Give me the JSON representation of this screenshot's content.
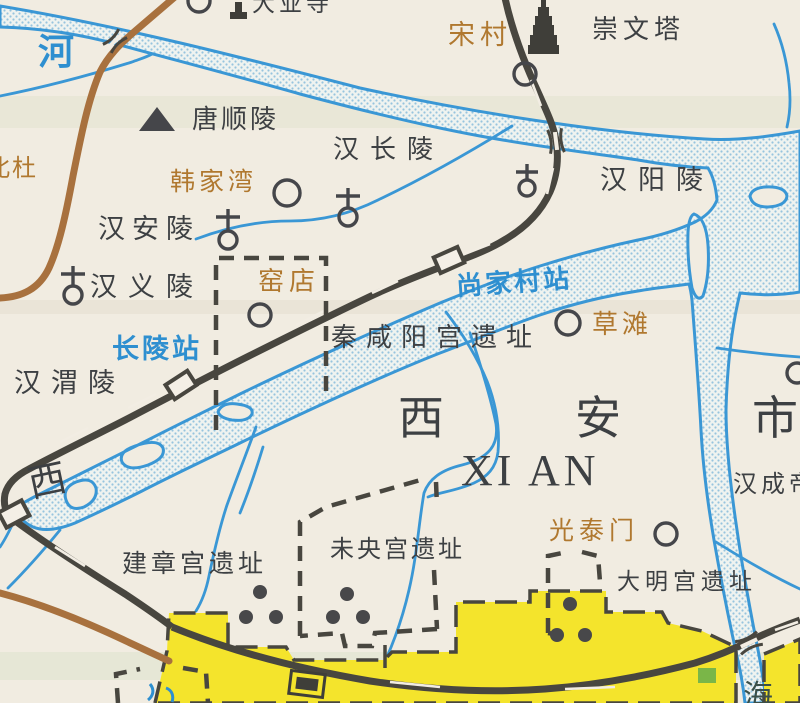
{
  "map": {
    "region_name_zh": "西安市",
    "region_name_en": "XI AN",
    "labels": {
      "dayesi_temple": "大业寺",
      "songcun_village": "宋村",
      "chongwenta_pagoda": "崇文塔",
      "river_char": "河",
      "tangshunling_tomb": "唐顺陵",
      "hanchangling_tomb": "汉长陵",
      "hanyangling_tomb": "汉阳陵",
      "hanjiawan_village": "韩家湾",
      "hananling_tomb": "汉安陵",
      "beidu_village": "北杜",
      "hanyiling_tomb": "汉义陵",
      "yaodian_village": "窑店",
      "shangjiacun_station": "尚家村站",
      "qin_xianyang_palace_site": "秦咸阳宫遗址",
      "caotan_village": "草滩",
      "changling_station": "长陵站",
      "hanweiling_tomb": "汉渭陵",
      "xi_fragment": "西",
      "hanchengdi_tomb": "汉成帝",
      "guangtaimen_gate": "光泰门",
      "weiyang_palace_site": "未央宫遗址",
      "jianzhang_palace_site": "建章宫遗址",
      "daming_palace_site": "大明宫遗址",
      "hai_fragment": "海"
    },
    "colors": {
      "paper": "#f1ece1",
      "water_outline": "#3a97d5",
      "water_dots": "#97c4de",
      "railway": "#48463f",
      "road": "#a8713e",
      "urban_area": "#f4e42c",
      "label_dark": "#3d4043",
      "label_brown": "#b0782f",
      "label_blue": "#2e8fd0",
      "green_patch": "#7ab648"
    }
  }
}
